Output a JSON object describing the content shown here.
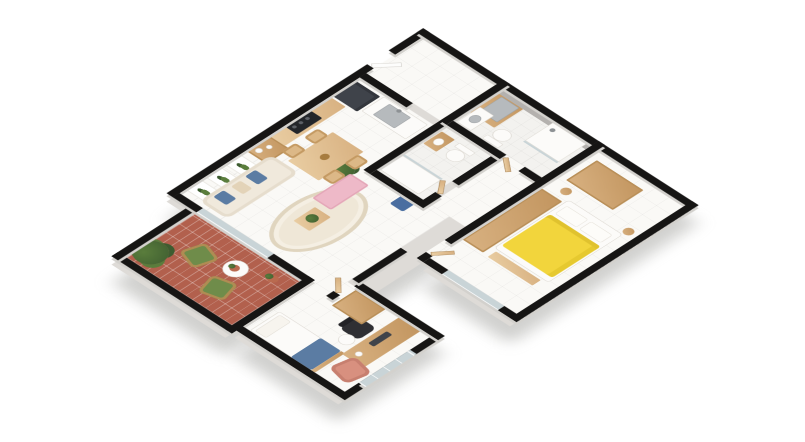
{
  "app": {
    "kind": "3d-isometric-floorplan-render",
    "background": "#ffffff"
  },
  "colors": {
    "wall": "#161514",
    "wallSide": "#d3d1cd",
    "slab": "#dedbd7",
    "floor": "#faf9f6",
    "floorLine": "rgba(0,0,0,0.05)",
    "bathFloor": "#f3f2ef",
    "brick": "#b2604d",
    "brickLine": "rgba(255,255,255,0.30)",
    "glass": "#c9d4d7",
    "grayWall": "#b4b1ae",
    "wood": "#d8b181",
    "woodDark": "#c2955f",
    "woodLight": "#e9cda2",
    "rattan": "#dcb887",
    "sofa": "#f0e9dc",
    "pillowBlue": "#5b7ca3",
    "rug": "#efe7d7",
    "rugBorder": "#e0d5bf",
    "pink": "#eeb9c8",
    "yellow": "#f2d53c",
    "fridge": "#3f434a",
    "steel": "#b6babd",
    "greenChair": "#6f8c4a",
    "plantDark": "#3d5c30",
    "plantMid": "#5a7d3c",
    "terracotta": "#b96a4f",
    "armchair": "#d8907f",
    "chairBlack": "#2f2f33"
  },
  "rooms": [
    {
      "name": "Living / dining room"
    },
    {
      "name": "Kitchen"
    },
    {
      "name": "Entry hall"
    },
    {
      "name": "Laundry nook"
    },
    {
      "name": "Main bathroom"
    },
    {
      "name": "Service bathroom"
    },
    {
      "name": "Hallway"
    },
    {
      "name": "Master bedroom"
    },
    {
      "name": "Second bedroom"
    },
    {
      "name": "Balcony terrace"
    }
  ]
}
